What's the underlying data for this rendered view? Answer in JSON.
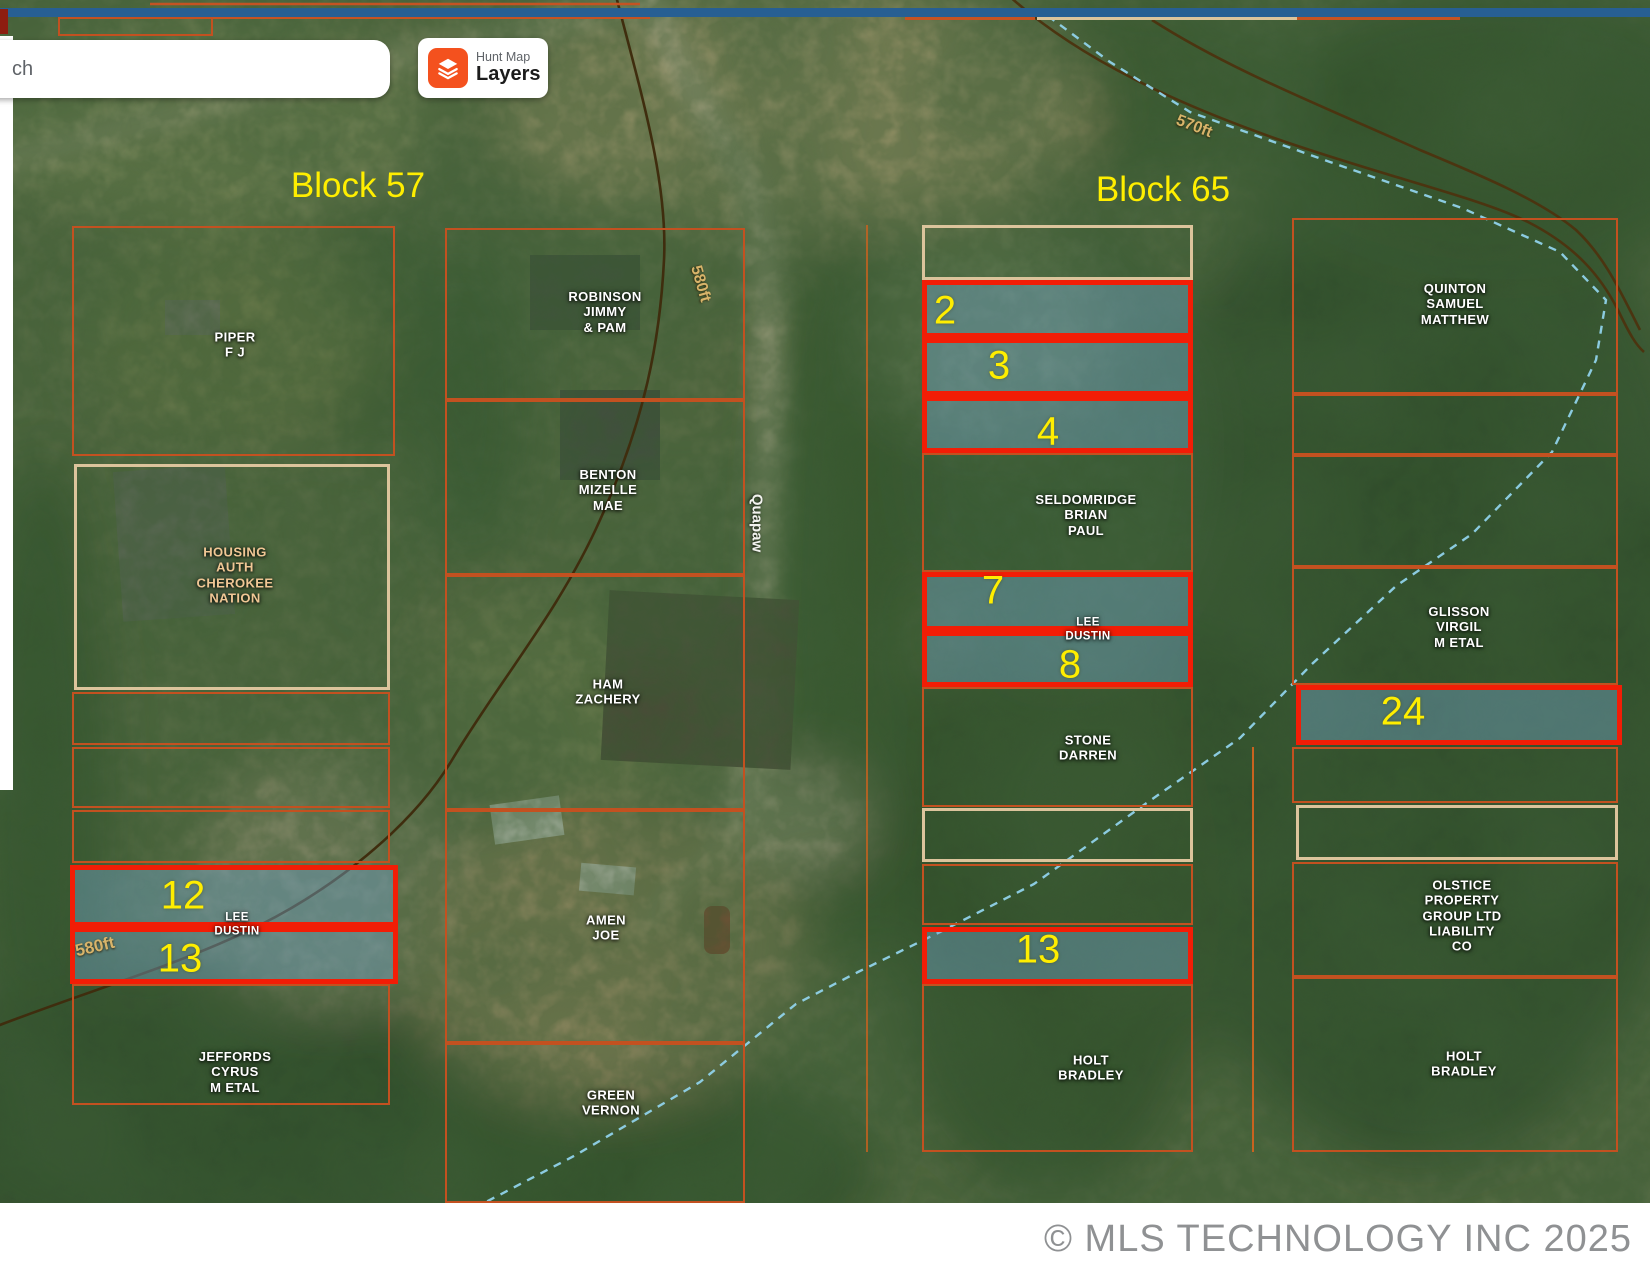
{
  "ui": {
    "search": {
      "value": "ch"
    },
    "layers_card": {
      "app": "Hunt Map",
      "label": "Layers"
    },
    "footer": {
      "copyright": "© MLS TECHNOLOGY INC 2025"
    }
  },
  "map": {
    "blocks": [
      {
        "label": "Block 57"
      },
      {
        "label": "Block 65"
      }
    ],
    "street": {
      "label": "Quapaw"
    },
    "contours": [
      {
        "label": "570ft"
      },
      {
        "label": "580ft"
      },
      {
        "label": "580ft"
      }
    ],
    "owners": [
      {
        "id": "piper",
        "label": "PIPER\nF J"
      },
      {
        "id": "housing-auth",
        "label": "HOUSING\nAUTH\nCHEROKEE\nNATION"
      },
      {
        "id": "lee-dustin-b57",
        "label": "LEE\nDUSTIN"
      },
      {
        "id": "jeffords",
        "label": "JEFFORDS\nCYRUS\nM ETAL"
      },
      {
        "id": "robinson",
        "label": "ROBINSON\nJIMMY\n& PAM"
      },
      {
        "id": "benton",
        "label": "BENTON\nMIZELLE\nMAE"
      },
      {
        "id": "ham",
        "label": "HAM\nZACHERY"
      },
      {
        "id": "amen",
        "label": "AMEN\nJOE"
      },
      {
        "id": "green",
        "label": "GREEN\nVERNON"
      },
      {
        "id": "seldomridge",
        "label": "SELDOMRIDGE\nBRIAN\nPAUL"
      },
      {
        "id": "lee-dustin-b65",
        "label": "LEE\nDUSTIN"
      },
      {
        "id": "stone",
        "label": "STONE\nDARREN"
      },
      {
        "id": "holt-b65-mid",
        "label": "HOLT\nBRADLEY"
      },
      {
        "id": "quinton",
        "label": "QUINTON\nSAMUEL\nMATTHEW"
      },
      {
        "id": "glisson",
        "label": "GLISSON\nVIRGIL\nM ETAL"
      },
      {
        "id": "olstice",
        "label": "OLSTICE\nPROPERTY\nGROUP LTD\nLIABILITY\nCO"
      },
      {
        "id": "holt-b65-right",
        "label": "HOLT\nBRADLEY"
      }
    ],
    "lot_numbers": [
      {
        "block": "57",
        "label": "12"
      },
      {
        "block": "57",
        "label": "13"
      },
      {
        "block": "65",
        "label": "2"
      },
      {
        "block": "65",
        "label": "3"
      },
      {
        "block": "65",
        "label": "4"
      },
      {
        "block": "65",
        "label": "7"
      },
      {
        "block": "65",
        "label": "8"
      },
      {
        "block": "65",
        "label": "13"
      },
      {
        "block": "65",
        "label": "24"
      }
    ],
    "colors": {
      "highlight_border": "#f21d06",
      "highlight_fill": "rgba(116,166,205,0.42)",
      "parcel_line": "#c35120",
      "parcel_line_tan": "#dcc49c",
      "lot_number": "#ffee00",
      "block_label": "#ffee00",
      "creek": "#90d2ea",
      "topbar": "#275f93"
    }
  }
}
